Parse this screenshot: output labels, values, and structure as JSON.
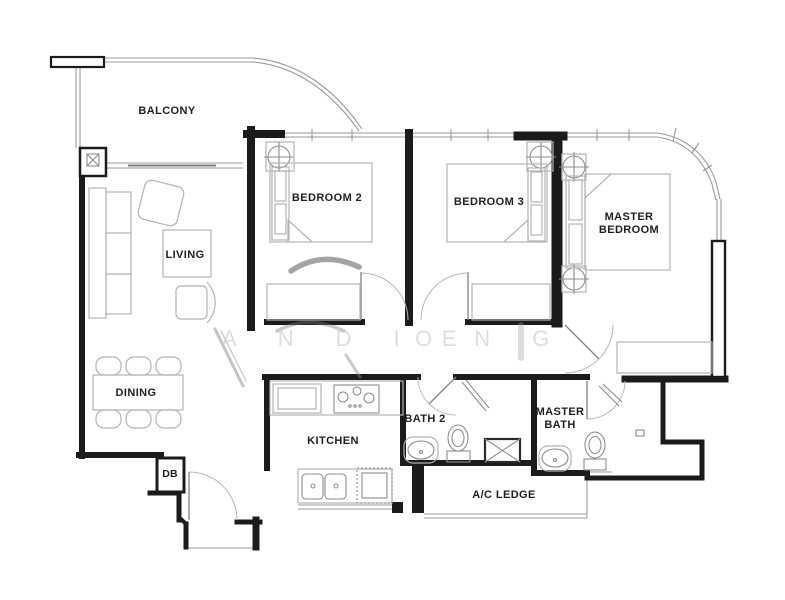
{
  "floorplan": {
    "labels": {
      "balcony": "BALCONY",
      "living": "LIVING",
      "dining": "DINING",
      "bedroom2": "BEDROOM 2",
      "bedroom3": "BEDROOM 3",
      "master_bedroom": "MASTER BEDROOM",
      "kitchen": "KITCHEN",
      "bath2": "BATH 2",
      "master_bath": "MASTER BATH",
      "ac_ledge": "A/C LEDGE",
      "db": "DB"
    },
    "watermark": {
      "left_text": "A N D I E",
      "right_text": "O N G"
    },
    "colors": {
      "background": "#ffffff",
      "wall": "#1b1b1b",
      "window": "#9a9a9a",
      "furniture": "#b3b3b3",
      "fixture": "#8d8d8d",
      "label_text": "#1f1f1f",
      "watermark": "#c3c3c3"
    }
  }
}
